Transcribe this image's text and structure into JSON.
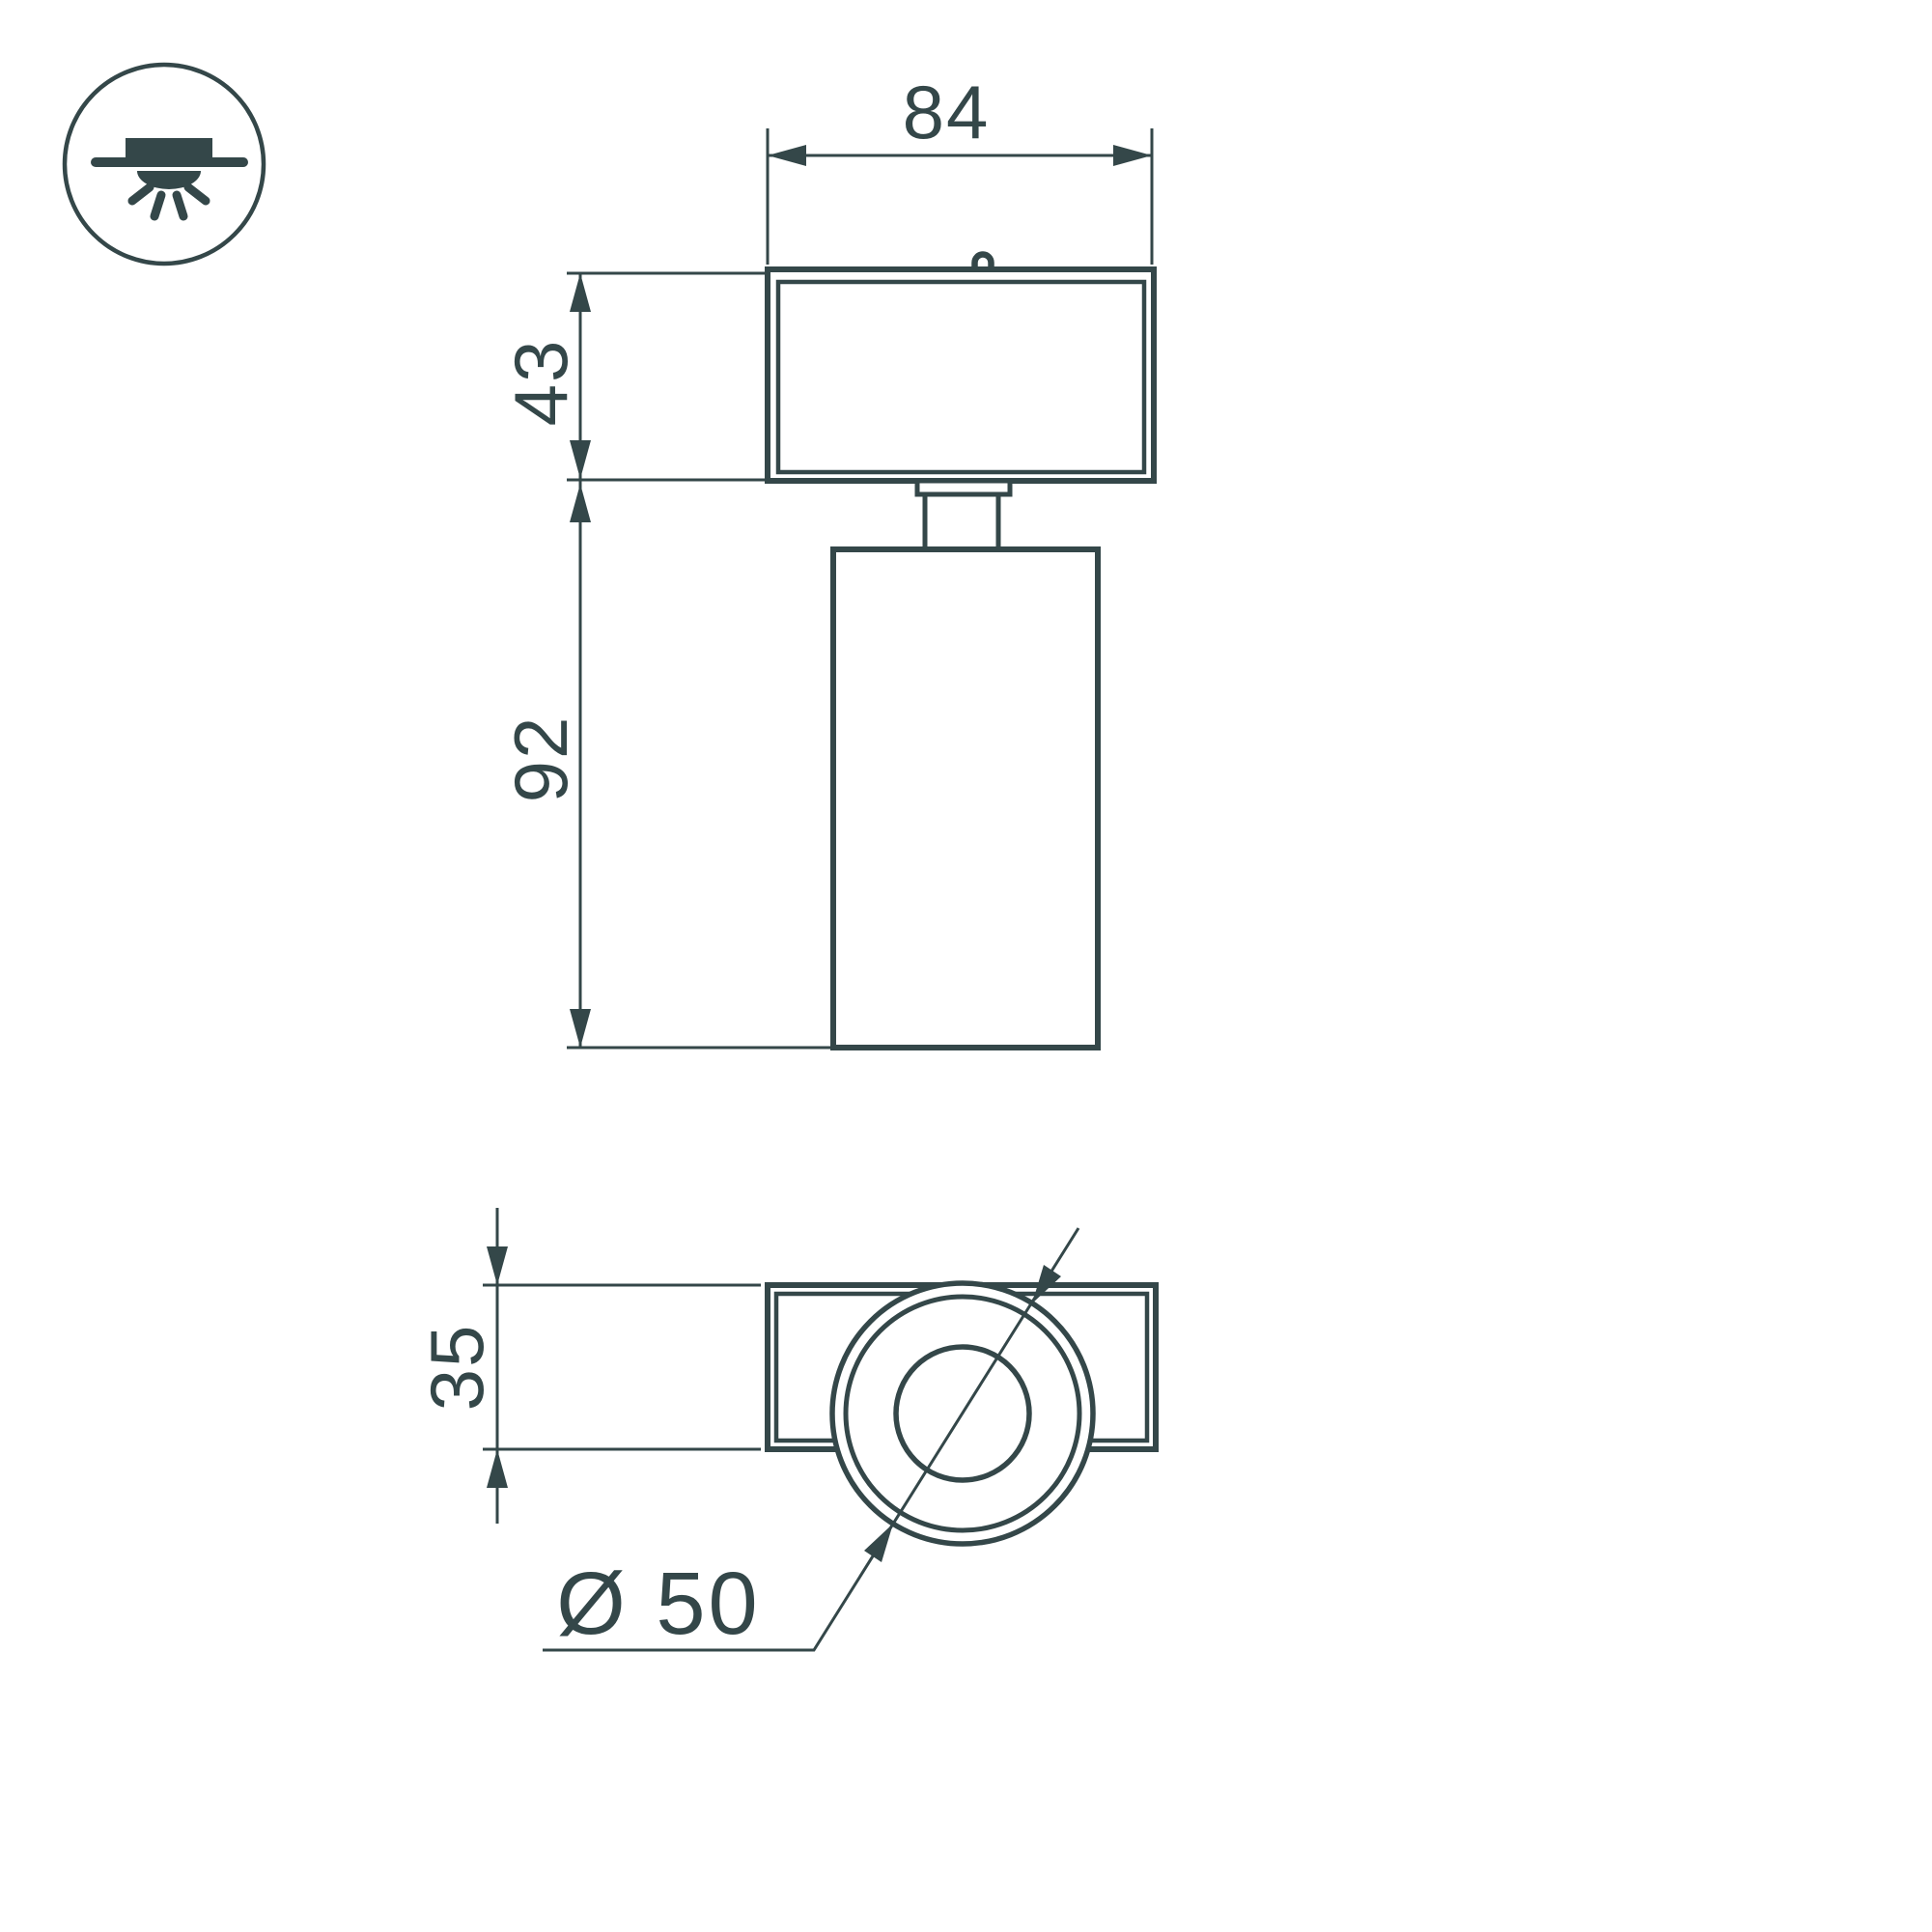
{
  "meta": {
    "background": "#ffffff",
    "ink_color": "#344749",
    "drawing_kind": "luminaire dimension drawing, front view and top view"
  },
  "icon": {
    "name": "surface-mounted-ceiling-light"
  },
  "front_view": {
    "dim_width": "84",
    "dim_bracket_height": "43",
    "dim_body_height": "92"
  },
  "top_view": {
    "dim_bracket_depth": "35",
    "dim_diameter": "Ø 50"
  }
}
